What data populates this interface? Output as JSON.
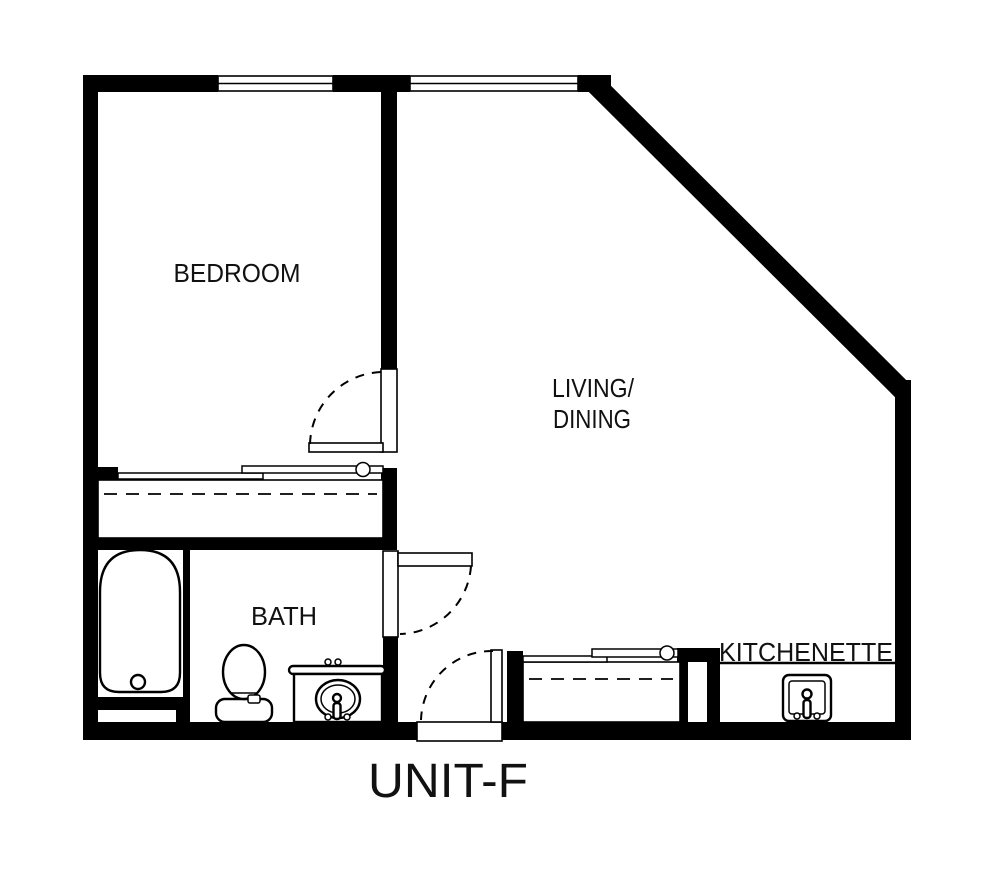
{
  "plan": {
    "title": "UNIT-F",
    "rooms": {
      "bedroom": {
        "label": "BEDROOM"
      },
      "living_dining": {
        "line1": "LIVING/",
        "line2": "DINING"
      },
      "bath": {
        "label": "BATH"
      },
      "kitchenette": {
        "label": "KITCHENETTE"
      }
    },
    "fixtures": {
      "bathtub": "bathtub",
      "toilet": "toilet",
      "vanity_sink": "vanity-sink",
      "kitchenette_sink": "kitchenette-sink",
      "closets": [
        "bedroom-closet",
        "hall-closet"
      ],
      "doors": [
        "bedroom-door",
        "bath-door",
        "entry-door"
      ],
      "windows": [
        "bedroom-window",
        "living-window"
      ]
    },
    "colors": {
      "wall": "#000000",
      "background": "#ffffff",
      "text": "#111111"
    }
  }
}
